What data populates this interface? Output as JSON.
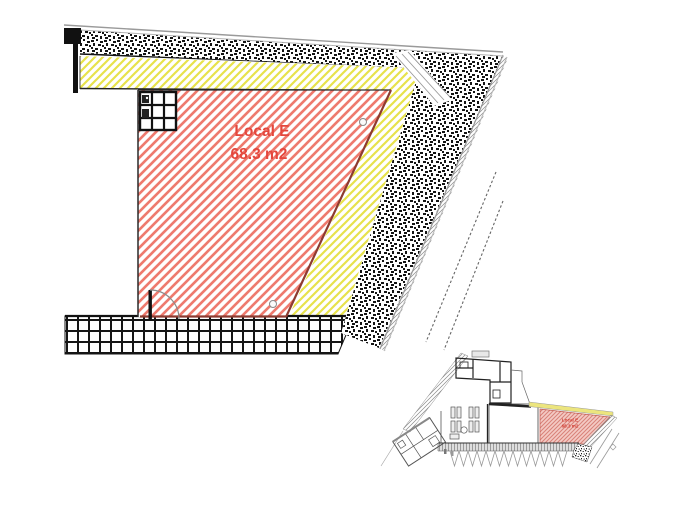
{
  "main_plan": {
    "room_label": {
      "name": "Local E",
      "area": "68.3 m2"
    },
    "colors": {
      "hatch_red": "#ee7a6e",
      "hatch_yellow": "#e7e24b",
      "label_red": "#e4473d",
      "edge_dark_red": "#8e3b30",
      "wall_black": "#151515"
    }
  },
  "inset_plan": {
    "room_label": {
      "name": "Local E",
      "area": "68.3 m2"
    },
    "colors": {
      "highlight_pink": "#f4cbc5",
      "hatch_red_small": "#d9837a"
    }
  }
}
